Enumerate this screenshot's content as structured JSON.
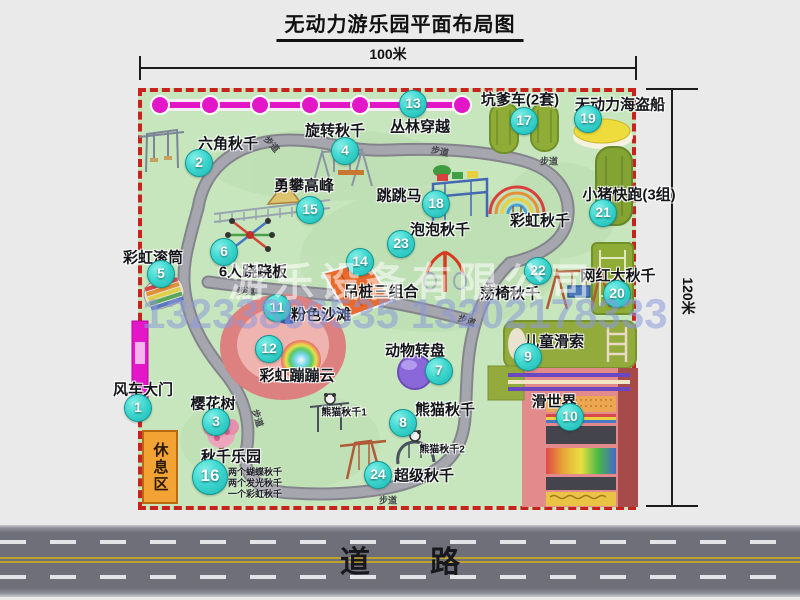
{
  "title": "无动力游乐园平面布局图",
  "dims": {
    "width": "100米",
    "height": "120米"
  },
  "road": {
    "label": "道　　路"
  },
  "rest_area": {
    "label": "休息区"
  },
  "trail": "步道",
  "watermark": {
    "company": "游乐设备有限公司",
    "phone": "13233806535 13202178333"
  },
  "extra": {
    "rainbow_swing": "彩虹秋千",
    "panda1": "熊猫秋千1",
    "panda2": "熊猫秋千2"
  },
  "colors": {
    "badge": "#22c4be",
    "border_dash": "#c8221e",
    "map_green": "#c7e6bd",
    "magenta": "#e316c8",
    "road_gray": "#6f6f79",
    "rest_orange": "#f2a333"
  },
  "attractions": [
    {
      "num": 1,
      "name": "风车大门"
    },
    {
      "num": 2,
      "name": "六角秋千"
    },
    {
      "num": 3,
      "name": "樱花树"
    },
    {
      "num": 4,
      "name": "旋转秋千"
    },
    {
      "num": 5,
      "name": "彩虹滚筒"
    },
    {
      "num": 6,
      "name": "6人跷跷板"
    },
    {
      "num": 7,
      "name": "动物转盘"
    },
    {
      "num": 8,
      "name": "熊猫秋千"
    },
    {
      "num": 9,
      "name": "儿童滑索"
    },
    {
      "num": 10,
      "name": "滑世界"
    },
    {
      "num": 11,
      "name": "粉色沙滩"
    },
    {
      "num": 12,
      "name": "彩虹蹦蹦云"
    },
    {
      "num": 13,
      "name": "丛林穿越"
    },
    {
      "num": 14,
      "name": "吊桩三组合"
    },
    {
      "num": 15,
      "name": "勇攀高峰"
    },
    {
      "num": 16,
      "name": "秋千乐园",
      "notes": [
        "两个蝴蝶秋千",
        "两个发光秋千",
        "一个彩虹秋千"
      ]
    },
    {
      "num": 17,
      "name": "坑爹车(2套)"
    },
    {
      "num": 18,
      "name": "跳跳马"
    },
    {
      "num": 19,
      "name": "无动力海盗船"
    },
    {
      "num": 20,
      "name": "网红大秋千"
    },
    {
      "num": 21,
      "name": "小猪快跑(3组)"
    },
    {
      "num": 22,
      "name": "荡椅秋千"
    },
    {
      "num": 23,
      "name": "泡泡秋千"
    },
    {
      "num": 24,
      "name": "超级秋千"
    }
  ]
}
